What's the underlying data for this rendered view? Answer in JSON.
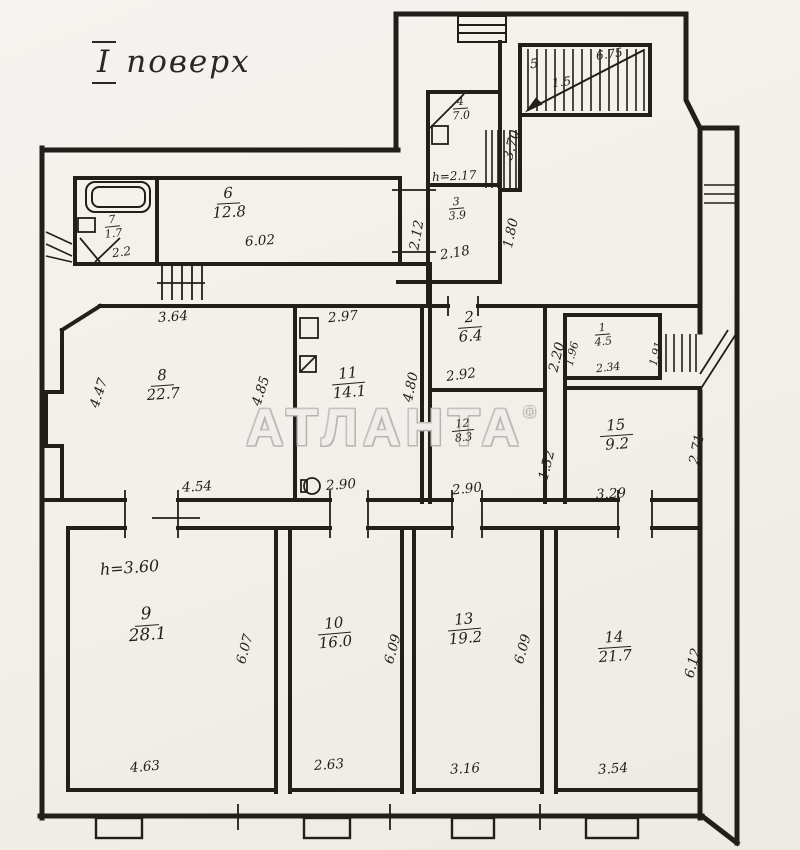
{
  "title": {
    "prefix": "І",
    "rest": "поверх"
  },
  "watermark": {
    "text": "АТЛАНТА",
    "reg": "®"
  },
  "colors": {
    "ink": "#221f1b",
    "paper": "#f2efe9",
    "watermark_outline": "#bdbab6"
  },
  "rooms": {
    "r1": {
      "number": "1",
      "area": "4.5",
      "dims": {
        "left": "1.96",
        "right": "1.91",
        "bottom": "2.34"
      }
    },
    "r2": {
      "number": "2",
      "area": "6.4",
      "dims": {
        "bottom": "2.92",
        "right": "2.20"
      }
    },
    "r3": {
      "number": "3",
      "area": "3.9",
      "dims": {
        "bottom": "2.18",
        "right": "1.80"
      }
    },
    "r4": {
      "number": "4",
      "area": "7.0",
      "dims": {
        "right": "3.70"
      },
      "height_note": "h=2.17"
    },
    "r6": {
      "number": "6",
      "area": "12.8",
      "dims": {
        "bottom": "6.02",
        "right": "2.12"
      }
    },
    "r7": {
      "number": "7",
      "area": "1.7",
      "note": "2.2"
    },
    "r8": {
      "number": "8",
      "area": "22.7",
      "dims": {
        "top": "3.64",
        "left": "4.47",
        "right": "4.85",
        "bottom": "4.54"
      }
    },
    "r9": {
      "number": "9",
      "area": "28.1",
      "dims": {
        "right": "6.07",
        "bottom": "4.63"
      },
      "height_note": "h=3.60"
    },
    "r10": {
      "number": "10",
      "area": "16.0",
      "dims": {
        "right": "6.09",
        "bottom": "2.63"
      }
    },
    "r11": {
      "number": "11",
      "area": "14.1",
      "dims": {
        "top": "2.97",
        "right": "4.80",
        "bottom": "2.90"
      }
    },
    "r12": {
      "number": "12",
      "area": "8.3",
      "dims": {
        "bottom": "2.90",
        "right": "1.52"
      }
    },
    "r13": {
      "number": "13",
      "area": "19.2",
      "dims": {
        "right": "6.09",
        "bottom": "3.16"
      }
    },
    "r14": {
      "number": "14",
      "area": "21.7",
      "dims": {
        "right": "6.12",
        "bottom": "3.54"
      }
    },
    "r15": {
      "number": "15",
      "area": "9.2",
      "dims": {
        "bottom": "3.29",
        "right": "2.71"
      }
    },
    "stairs": {
      "number": "5",
      "area": "1.5",
      "dim": "6.75"
    }
  }
}
